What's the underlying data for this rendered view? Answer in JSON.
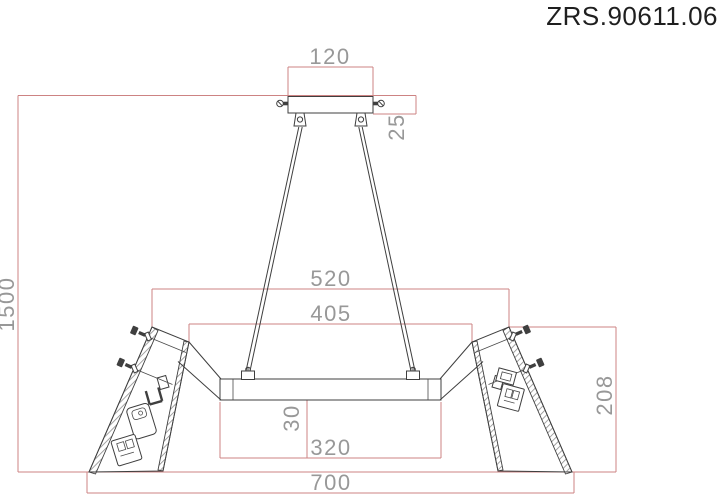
{
  "title": "ZRS.90611.06",
  "colors": {
    "dimension_line": "#cd8383",
    "dimension_text": "#989898",
    "drawing_line": "#3f3f3f",
    "background": "#ffffff"
  },
  "dimensions": {
    "canopy_width": "120",
    "canopy_height": "25",
    "drop_height": "1500",
    "frame_outer_width": "520",
    "frame_inner_width": "405",
    "bar_height": "30",
    "bar_bottom_width": "320",
    "total_width": "700",
    "shade_height": "208"
  }
}
